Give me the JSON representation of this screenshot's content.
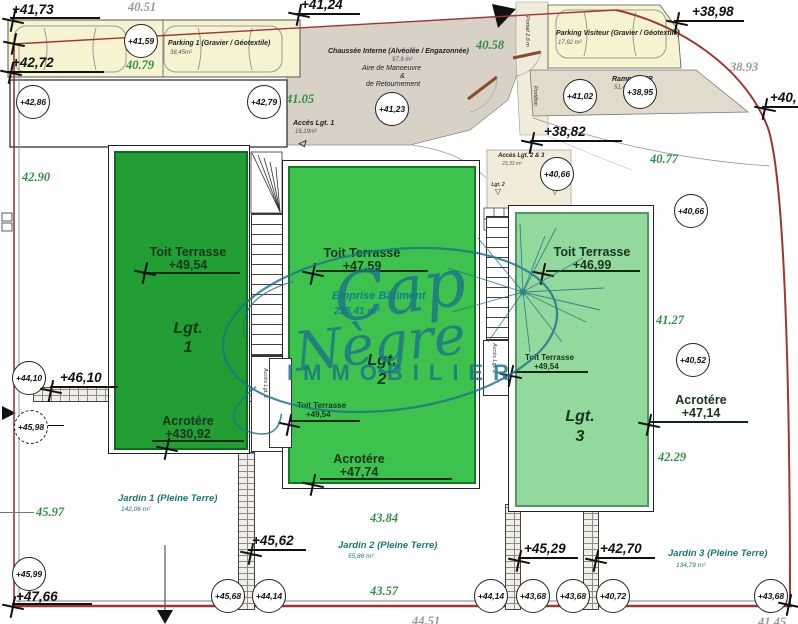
{
  "watermark": {
    "word1": "Cap",
    "word2": "Nègre",
    "word3": "IMMOBILIER"
  },
  "zones": {
    "parking1": {
      "name": "Parking 1 (Gravier / Géotextile)",
      "area": "38,45m²"
    },
    "parking_visiteur": {
      "name": "Parking Visiteur (Gravier / Géotextile)",
      "area": "17,62 m²"
    },
    "rampe_pmr": {
      "name": "Rampe PMR",
      "area": "51,44 m²"
    },
    "chaussee": {
      "name": "Chaussée Interne (Alvéolée / Engazonnée)",
      "area": "97,9 m²",
      "sub1": "Aire de Manoeuvre",
      "sub2": "&",
      "sub3": "de Retournement"
    },
    "acces_lgt1": {
      "name": "Accès Lgt. 1",
      "area": "16,19m²"
    },
    "acces_lgt23": {
      "name": "Accès Lgt. 2 & 3",
      "area": "23,33 m²"
    },
    "jardin1": {
      "name": "Jardin 1 (Pleine Terre)",
      "area": "142,06 m²"
    },
    "jardin2": {
      "name": "Jardin 2 (Pleine Terre)",
      "area": "55,86 m²"
    },
    "jardin3": {
      "name": "Jardin 3 (Pleine Terre)",
      "area": "134,79 m²"
    },
    "emprise": {
      "name": "Emprise Bâtiment",
      "area": "235,41 m²"
    },
    "portail": "Portail 2,8 m",
    "portillon": "Portillon"
  },
  "buildings": {
    "lgt1": {
      "name": "Lgt.",
      "num": "1",
      "roof": "Toit Terrasse",
      "roof_level": "+49,54",
      "acro": "Acrotére",
      "acro_level": "+430,92"
    },
    "lgt2": {
      "name": "Lgt.",
      "num": "2",
      "roof": "Toit Terrasse",
      "roof_level": "+47,59",
      "roof2": "Toit Terrasse",
      "roof2_level": "+49,54",
      "acro": "Acrotére",
      "acro_level": "+47,74"
    },
    "lgt3": {
      "name": "Lgt.",
      "num": "3",
      "roof": "Toit Terrasse",
      "roof_level": "+46,99",
      "roof2": "Toit Terrasse",
      "roof2_level": "+49,54",
      "acro": "Acrotére",
      "acro_level": "+47,14"
    }
  },
  "levels": {
    "p4173": "+41,73",
    "p4124": "+41,24",
    "p3898": "+38,98",
    "p4272": "+42,72",
    "p3882": "+38,82",
    "p40": "+40,",
    "p4610": "+46,10",
    "p4562": "+45,62",
    "p4529": "+45,29",
    "p4270": "+42,70",
    "p4766": "+47,66"
  },
  "spots": {
    "s4159": "+41,59",
    "s4286": "+42,86",
    "s4279": "+42,79",
    "s4123": "+41,23",
    "s4102": "+41,02",
    "s3895": "+38,95",
    "s4066a": "+40,66",
    "s4066b": "+40,66",
    "s4052": "+40,52",
    "s4410": "+44,10",
    "s4598": "+45,98",
    "s4599": "+45,99",
    "s4568": "+45,68",
    "s4414a": "+44,14",
    "s4414b": "+44,14",
    "s4368a": "+43,68",
    "s4368b": "+43,68",
    "s4072": "+40,72",
    "s4368c": "+43,68"
  },
  "terrain": {
    "t4079": "40.79",
    "t4105": "41.05",
    "t4058": "40.58",
    "t4077": "40.77",
    "t4290": "42.90",
    "t4127": "41.27",
    "t4229": "42.29",
    "t4384": "43.84",
    "t4357": "43.57",
    "t4597": "45.97"
  },
  "dims": {
    "d4051": "40.51",
    "d3893": "38.93",
    "d4451": "44.51",
    "d4145": "41.45"
  },
  "stairs": {
    "acces1_arrow": "Accès Lgt. 1",
    "acces2_arrow": "Accès Lgt. 2",
    "lgt2_door": "Lgt. 2",
    "lgt3_door": "Lgt. 3"
  }
}
